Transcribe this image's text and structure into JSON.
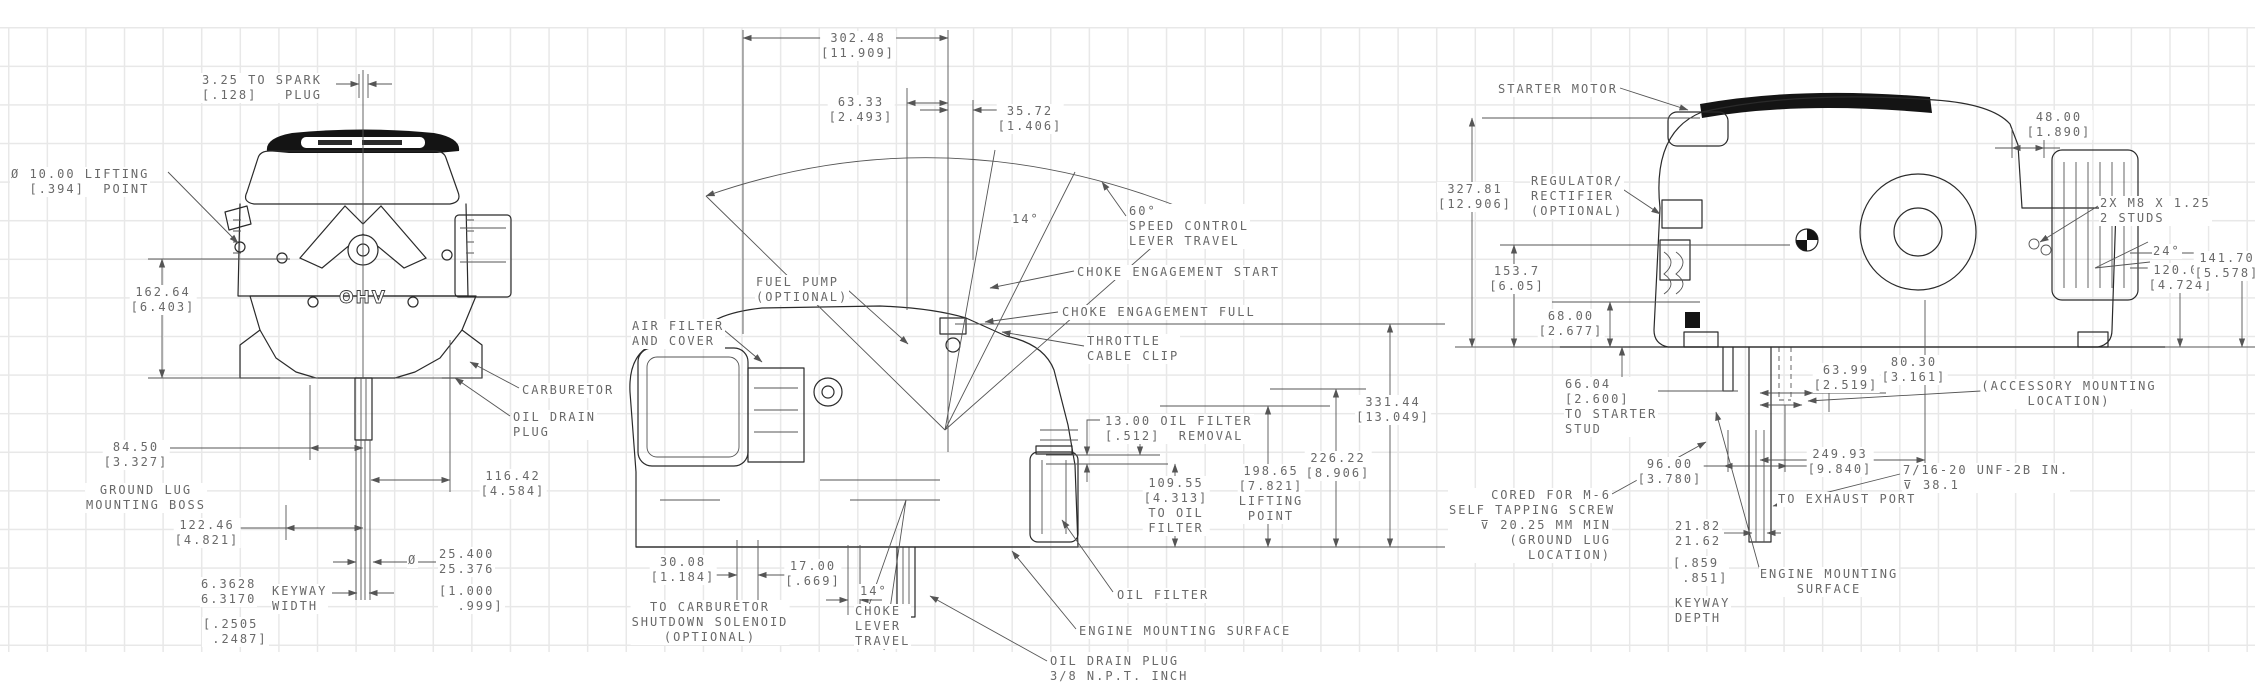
{
  "title": "engine-dimension-drawing",
  "badge": "OHV",
  "colors": {
    "background": "#ffffff",
    "grid": "#e8e8e8",
    "art": "#2a2a2a",
    "dim": "#555555",
    "text": "#696969",
    "cap": "#141414"
  },
  "labels": {
    "left": {
      "spark_plug": "3.25 TO SPARK\n[.128]   PLUG",
      "lifting_point": "Ø 10.00 LIFTING\n  [.394]  POINT",
      "h162": "162.64\n[6.403]",
      "h84": "84.50\n[3.327]",
      "ground_lug": "GROUND LUG\nMOUNTING BOSS",
      "h122": "122.46\n[4.821]",
      "keyway_mm": "6.3628\n6.3170",
      "keyway_label": "KEYWAY\nWIDTH",
      "keyway_in": "[.2505\n .2487]",
      "dia_symbol": "Ø",
      "shaft_mm": "25.400\n25.376",
      "shaft_in": "[1.000\n  .999]",
      "h116": "116.42\n[4.584]",
      "carburetor": "CARBURETOR",
      "oil_drain": "OIL DRAIN\nPLUG"
    },
    "middle": {
      "w302": "302.48\n[11.909]",
      "w63": "63.33\n[2.493]",
      "w35": "35.72\n[1.406]",
      "a14_top": "14°",
      "speed_control": "60°\nSPEED CONTROL\nLEVER TRAVEL",
      "choke_start": "CHOKE ENGAGEMENT START",
      "choke_full": "CHOKE ENGAGEMENT FULL",
      "throttle_clip": "THROTTLE\nCABLE CLIP",
      "fuel_pump": "FUEL PUMP\n(OPTIONAL)",
      "air_filter": "AIR FILTER\nAND COVER",
      "filter_removal": "13.00 OIL FILTER\n[.512]  REMOVAL",
      "h109": "109.55\n[4.313]\nTO OIL\nFILTER",
      "h198": "198.65\n[7.821]\nLIFTING\nPOINT",
      "h226": "226.22\n[8.906]",
      "h331": "331.44\n[13.049]",
      "oil_filter": "OIL FILTER",
      "mounting_surface": "ENGINE MOUNTING SURFACE",
      "oil_drain_plug": "OIL DRAIN PLUG\n3/8 N.P.T. INCH",
      "w30": "30.08\n[1.184]",
      "to_carb": "TO CARBURETOR\nSHUTDOWN SOLENOID\n(OPTIONAL)",
      "w17": "17.00\n[.669]",
      "a14_bottom": "14°",
      "choke_travel": "CHOKE\nLEVER\nTRAVEL"
    },
    "right": {
      "starter_motor": "STARTER MOTOR",
      "w48": "48.00\n[1.890]",
      "h327": "327.81\n[12.906]",
      "regulator": "REGULATOR/\nRECTIFIER\n(OPTIONAL)",
      "studs": "2X M8 X 1.25\n2 STUDS",
      "h153": "153.7\n[6.05]",
      "a24": "24°",
      "w120": "120.00\n[4.724]",
      "w141": "141.70\n[5.578]",
      "h68": "68.00\n[2.677]",
      "h66": "66.04\n[2.600]\nTO STARTER\nSTUD",
      "w63": "63.99\n[2.519]",
      "w80": "80.30\n[3.161]",
      "accessory": "(ACCESSORY MOUNTING\nLOCATION)",
      "w96": "96.00\n[3.780]",
      "cored": "CORED FOR M-6\nSELF TAPPING SCREW\n⊽ 20.25 MM MIN\n(GROUND LUG\nLOCATION)",
      "keyway_mm": "21.82\n21.62",
      "keyway_in": "[.859\n .851]",
      "keyway_label": "KEYWAY\nDEPTH",
      "h249": "249.93\n[9.840]",
      "to_exhaust": "TO EXHAUST PORT",
      "unf": "7/16-20 UNF-2B IN.\n⊽ 38.1",
      "mounting_surface": "ENGINE MOUNTING\nSURFACE"
    }
  }
}
